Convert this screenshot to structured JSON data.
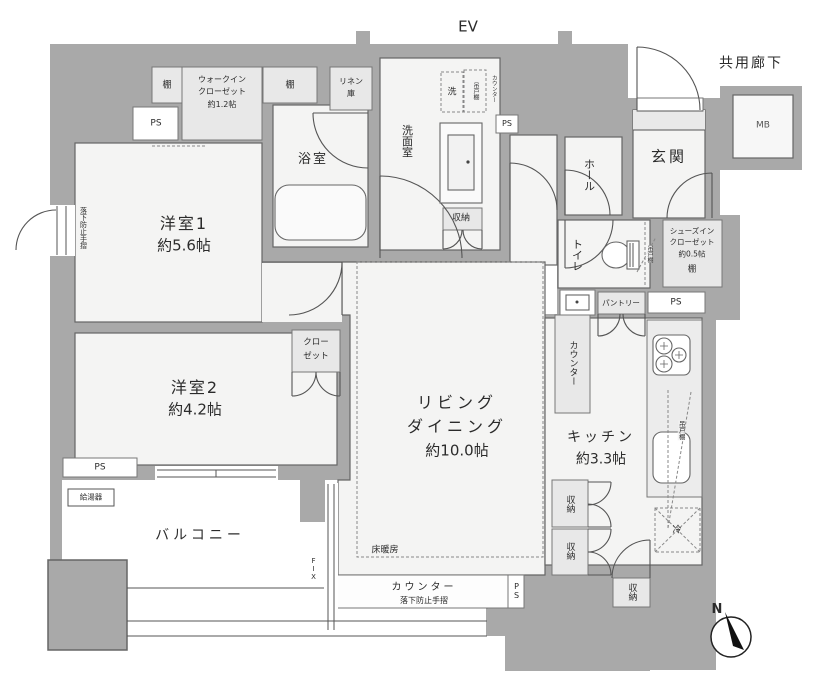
{
  "common": {
    "ev": "EV",
    "corridor": "共用廊下",
    "mb": "MB",
    "north": "N"
  },
  "rooms": {
    "room1": {
      "name": "洋室1",
      "size": "約5.6帖"
    },
    "room2": {
      "name": "洋室2",
      "size": "約4.2帖"
    },
    "living": {
      "line1": "リビング",
      "line2": "ダイニング",
      "size": "約10.0帖"
    },
    "kitchen": {
      "name": "キッチン",
      "size": "約3.3帖"
    },
    "balcony": "バルコニー",
    "bath": "浴室",
    "washroom": "洗面室",
    "toilet": "トイレ",
    "hall": "ホール",
    "genkan": "玄関"
  },
  "closets": {
    "wic": {
      "line1": "ウォークイン",
      "line2": "クローゼット",
      "size": "約1.2帖"
    },
    "closet": {
      "line1": "クロー",
      "line2": "ゼット"
    },
    "shoe": {
      "line1": "シューズイン",
      "line2": "クローゼット",
      "size": "約0.5帖",
      "shelf": "棚"
    },
    "linen": {
      "line1": "リネン",
      "line2": "庫"
    }
  },
  "labels": {
    "shelf": "棚",
    "ps": "PS",
    "storage": "収納",
    "washer": "洗",
    "fridge": "冷",
    "hanging_cabinet": "吊戸棚",
    "counter": "カウンター",
    "pantry": "パントリー",
    "floor_heating": "床暖房",
    "handrail": "落下防止手摺",
    "fix": "FIX",
    "water_heater": "給湯器"
  },
  "colors": {
    "wall": "#a9a9a9",
    "floor": "#f4f4f3",
    "box": "#e8e8e8",
    "line": "#666666"
  }
}
